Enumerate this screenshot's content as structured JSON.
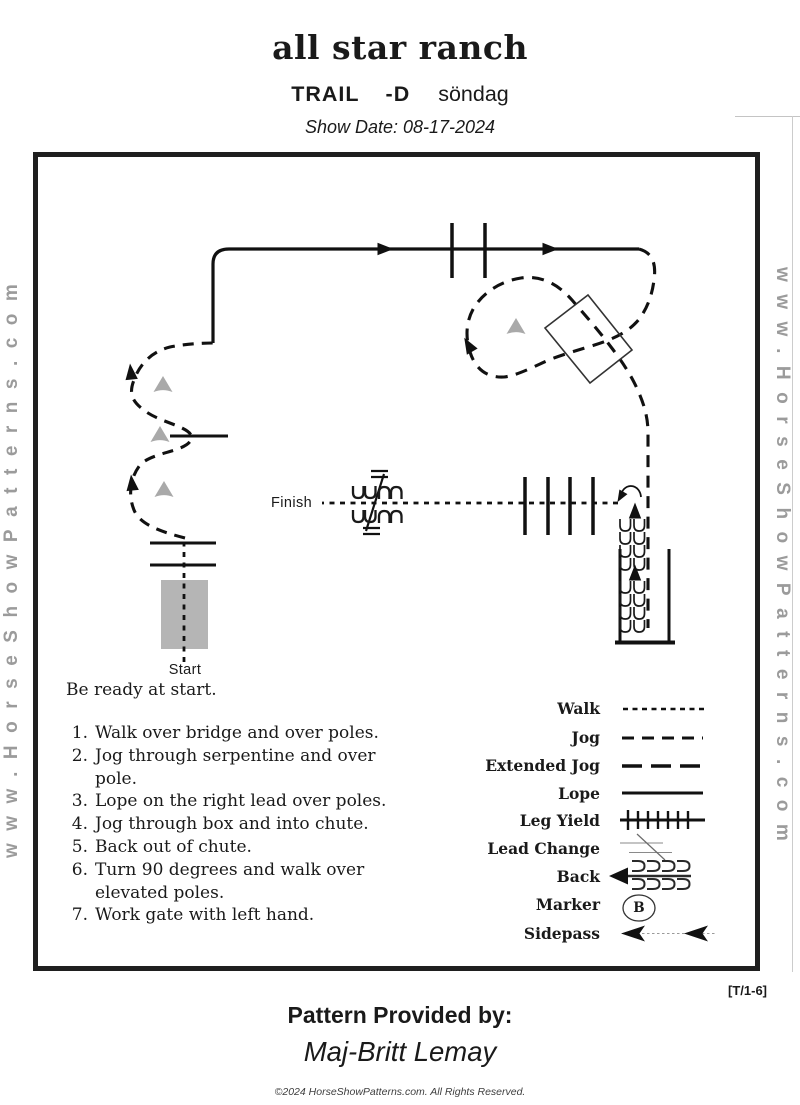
{
  "header": {
    "ranch_title": "all star ranch",
    "class_label": "TRAIL",
    "class_suffix": "-D",
    "day": "söndag",
    "show_date": "Show Date: 08-17-2024"
  },
  "diagram": {
    "start_label": "Start",
    "finish_label": "Finish",
    "marker_letter": "B"
  },
  "instructions": {
    "intro": "Be ready at start.",
    "items": [
      {
        "num": "1.",
        "text": "Walk over bridge and over poles."
      },
      {
        "num": "2.",
        "text": "Jog through serpentine and over pole."
      },
      {
        "num": "3.",
        "text": "Lope on the right lead over poles."
      },
      {
        "num": "4.",
        "text": "Jog through box and into chute."
      },
      {
        "num": "5.",
        "text": "Back out of  chute."
      },
      {
        "num": "6.",
        "text": "Turn 90 degrees and walk over elevated poles."
      },
      {
        "num": "7.",
        "text": "Work gate with left hand."
      }
    ]
  },
  "legend": {
    "items": [
      {
        "label": "Walk",
        "style": "short-dashed-line"
      },
      {
        "label": "Jog",
        "style": "dashed-line"
      },
      {
        "label": "Extended Jog",
        "style": "long-dashed-line"
      },
      {
        "label": "Lope",
        "style": "solid-line"
      },
      {
        "label": "Leg Yield",
        "style": "line-with-cross-ticks"
      },
      {
        "label": "Lead Change",
        "style": "thin-lines-with-slash"
      },
      {
        "label": "Back",
        "style": "left-arrow-with-coil-rows"
      },
      {
        "label": "Marker",
        "style": "circled-letter"
      },
      {
        "label": "Sidepass",
        "style": "dotted-line-with-left-arrows"
      }
    ]
  },
  "footer": {
    "pattern_ref": "[T/1-6]",
    "provided_by": "Pattern Provided by:",
    "provider_name": "Maj-Britt Lemay",
    "copyright": "©2024 HorseShowPatterns.com. All Rights Reserved."
  },
  "watermark": {
    "text": "www.HorseShowPatterns.com"
  },
  "colors": {
    "ink": "#1a1a1a",
    "watermark_gray": "#9b9b9b",
    "cone_gray": "#a9a9a9",
    "bridge_gray": "#b5b5b5"
  }
}
